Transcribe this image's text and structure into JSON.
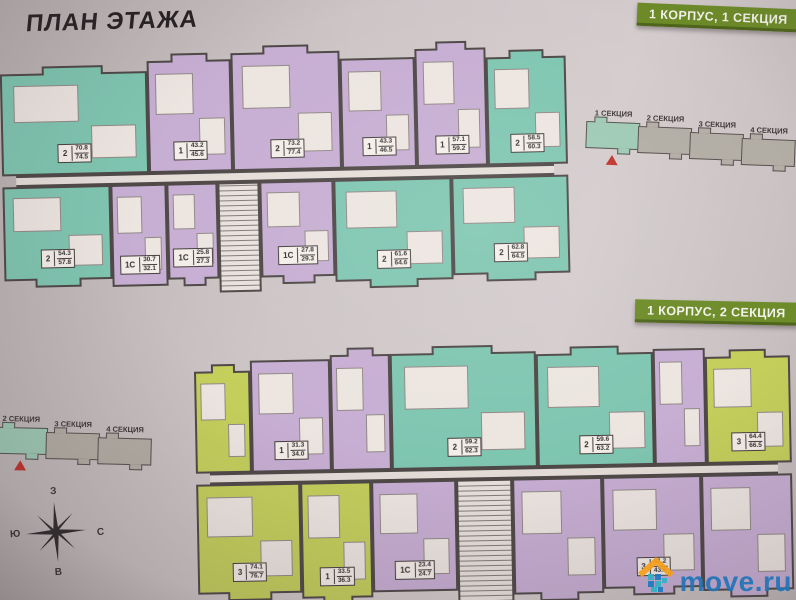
{
  "page": {
    "title": "ПЛАН ЭТАЖА",
    "watermark": {
      "text": "move.ru",
      "color": "#2175b8",
      "roof_color": "#f59f1c"
    }
  },
  "badges": [
    {
      "label": "1 КОРПУС, 1 СЕКЦИЯ",
      "color": "#6d8b28"
    },
    {
      "label": "1 КОРПУС, 2 СЕКЦИЯ",
      "color": "#6d8b28"
    }
  ],
  "locators": [
    {
      "sections": [
        {
          "label": "1 СЕКЦИЯ",
          "highlighted": true
        },
        {
          "label": "2 СЕКЦИЯ",
          "highlighted": false
        },
        {
          "label": "3 СЕКЦИЯ",
          "highlighted": false
        },
        {
          "label": "4 СЕКЦИЯ",
          "highlighted": false
        }
      ],
      "marker_color": "#c0312a"
    },
    {
      "sections": [
        {
          "label": "1 СЕКЦИЯ",
          "highlighted": false
        },
        {
          "label": "2 СЕКЦИЯ",
          "highlighted": true
        },
        {
          "label": "3 СЕКЦИЯ",
          "highlighted": false
        },
        {
          "label": "4 СЕКЦИЯ",
          "highlighted": false
        }
      ],
      "marker_color": "#c0312a"
    }
  ],
  "compass": {
    "top": "З",
    "left": "Ю",
    "right": "С",
    "bottom": "В"
  },
  "palette": {
    "teal": "#7fc6b1",
    "lavender": "#c7aed3",
    "yellowgreen": "#c4cf5b",
    "walls": "#4e4847"
  },
  "floorplans": [
    {
      "name": "1 корпус, 1 секция",
      "rows": [
        {
          "units": [
            {
              "type": "2",
              "area1": "70.8",
              "area2": "74.5",
              "color": "teal",
              "balcony": true
            },
            {
              "type": "1",
              "area1": "43.2",
              "area2": "45.6",
              "color": "lavender",
              "balcony": true
            },
            {
              "type": "2",
              "area1": "73.2",
              "area2": "77.4",
              "color": "lavender",
              "balcony": true
            },
            {
              "type": "1",
              "area1": "43.3",
              "area2": "46.5",
              "color": "lavender",
              "balcony": false
            },
            {
              "type": "1",
              "area1": "57.1",
              "area2": "59.2",
              "color": "lavender",
              "balcony": true
            },
            {
              "type": "2",
              "area1": "58.5",
              "area2": "60.3",
              "color": "teal",
              "balcony": true
            }
          ]
        },
        {
          "units": [
            {
              "type": "2",
              "area1": "54.3",
              "area2": "57.8",
              "color": "teal",
              "balcony": true
            },
            {
              "type": "1С",
              "area1": "30.7",
              "area2": "32.1",
              "color": "lavender",
              "balcony": false
            },
            {
              "type": "1С",
              "area1": "25.8",
              "area2": "27.3",
              "color": "lavender",
              "balcony": true
            },
            {
              "color": "stairs"
            },
            {
              "type": "1С",
              "area1": "27.8",
              "area2": "29.3",
              "color": "lavender",
              "balcony": true
            },
            {
              "type": "2",
              "area1": "61.6",
              "area2": "64.6",
              "color": "teal",
              "balcony": true
            },
            {
              "type": "2",
              "area1": "62.8",
              "area2": "64.5",
              "color": "teal",
              "balcony": true
            }
          ]
        }
      ]
    },
    {
      "name": "1 корпус, 2 секция",
      "rows": [
        {
          "units": [
            {
              "color": "yellowgreen",
              "balcony": true
            },
            {
              "type": "1",
              "area1": "31.3",
              "area2": "34.0",
              "color": "lavender",
              "balcony": false
            },
            {
              "color": "lavender",
              "balcony": true
            },
            {
              "type": "2",
              "area1": "59.2",
              "area2": "62.3",
              "color": "teal",
              "balcony": true
            },
            {
              "type": "2",
              "area1": "59.6",
              "area2": "63.2",
              "color": "teal",
              "balcony": true
            },
            {
              "color": "lavender",
              "balcony": false
            },
            {
              "type": "3",
              "area1": "64.4",
              "area2": "66.5",
              "color": "yellowgreen",
              "balcony": true
            }
          ]
        },
        {
          "units": [
            {
              "type": "3",
              "area1": "74.1",
              "area2": "76.7",
              "color": "yellowgreen",
              "balcony": true
            },
            {
              "type": "1",
              "area1": "33.5",
              "area2": "36.3",
              "color": "yellowgreen",
              "balcony": true
            },
            {
              "type": "1С",
              "area1": "23.4",
              "area2": "24.7",
              "color": "lavender",
              "balcony": false
            },
            {
              "color": "stairs"
            },
            {
              "color": "lavender",
              "balcony": true
            },
            {
              "type": "3",
              "area1": "41.2",
              "area2": "43.6",
              "color": "lavender",
              "balcony": true
            },
            {
              "color": "lavender",
              "balcony": true
            }
          ]
        }
      ]
    }
  ]
}
